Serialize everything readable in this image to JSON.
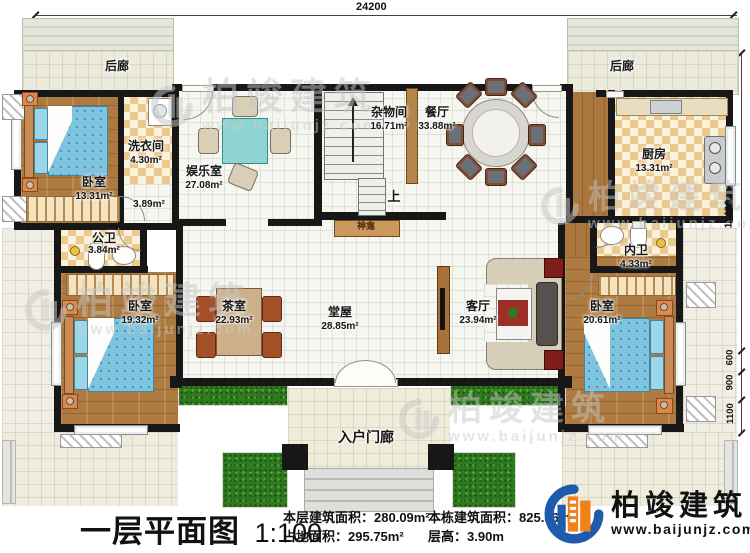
{
  "plan": {
    "dims": {
      "top": "24200",
      "right_total": "11400",
      "seg600": "600",
      "seg900": "900",
      "seg1100": "1100"
    },
    "rooms": {
      "porch_back_left": {
        "name": "后廊"
      },
      "porch_back_right": {
        "name": "后廊"
      },
      "bedroom1": {
        "name": "卧室",
        "area": "13.31m²"
      },
      "laundry": {
        "name": "洗衣间",
        "area": "4.30m²"
      },
      "hallway": {
        "area": "3.89m²"
      },
      "entertainment": {
        "name": "娱乐室",
        "area": "27.08m²"
      },
      "storage": {
        "name": "杂物间",
        "area": "16.71m²"
      },
      "dining": {
        "name": "餐厅",
        "area": "33.88m²"
      },
      "kitchen": {
        "name": "厨房",
        "area": "13.31m²"
      },
      "bath_public": {
        "name": "公卫",
        "area": "3.84m²"
      },
      "bath_private": {
        "name": "内卫",
        "area": "4.33m²"
      },
      "bedroom2": {
        "name": "卧室",
        "area": "19.32m²"
      },
      "tearoom": {
        "name": "茶室",
        "area": "22.93m²"
      },
      "hall_main": {
        "name": "堂屋",
        "area": "28.85m²"
      },
      "living": {
        "name": "客厅",
        "area": "23.94m²"
      },
      "bedroom3": {
        "name": "卧室",
        "area": "20.61m²"
      },
      "entry_porch": {
        "name": "入户门廊"
      }
    },
    "stairs": {
      "up": "上"
    },
    "shrine": {
      "name": "神龛"
    }
  },
  "watermark": {
    "name": "柏竣建筑",
    "url": "www.baijunjz.com"
  },
  "footer": {
    "title": "一层平面图",
    "scale": "1:100",
    "stats": [
      {
        "label": "本层建筑面积：",
        "value": "280.09m²"
      },
      {
        "label": "占地面积：",
        "value": "295.75m²"
      },
      {
        "label": "本栋建筑面积：",
        "value": "825.36m²"
      },
      {
        "label": "层高：",
        "value": "3.90m"
      }
    ],
    "brand": {
      "name": "柏竣建筑",
      "url": "www.baijunjz.com"
    }
  }
}
